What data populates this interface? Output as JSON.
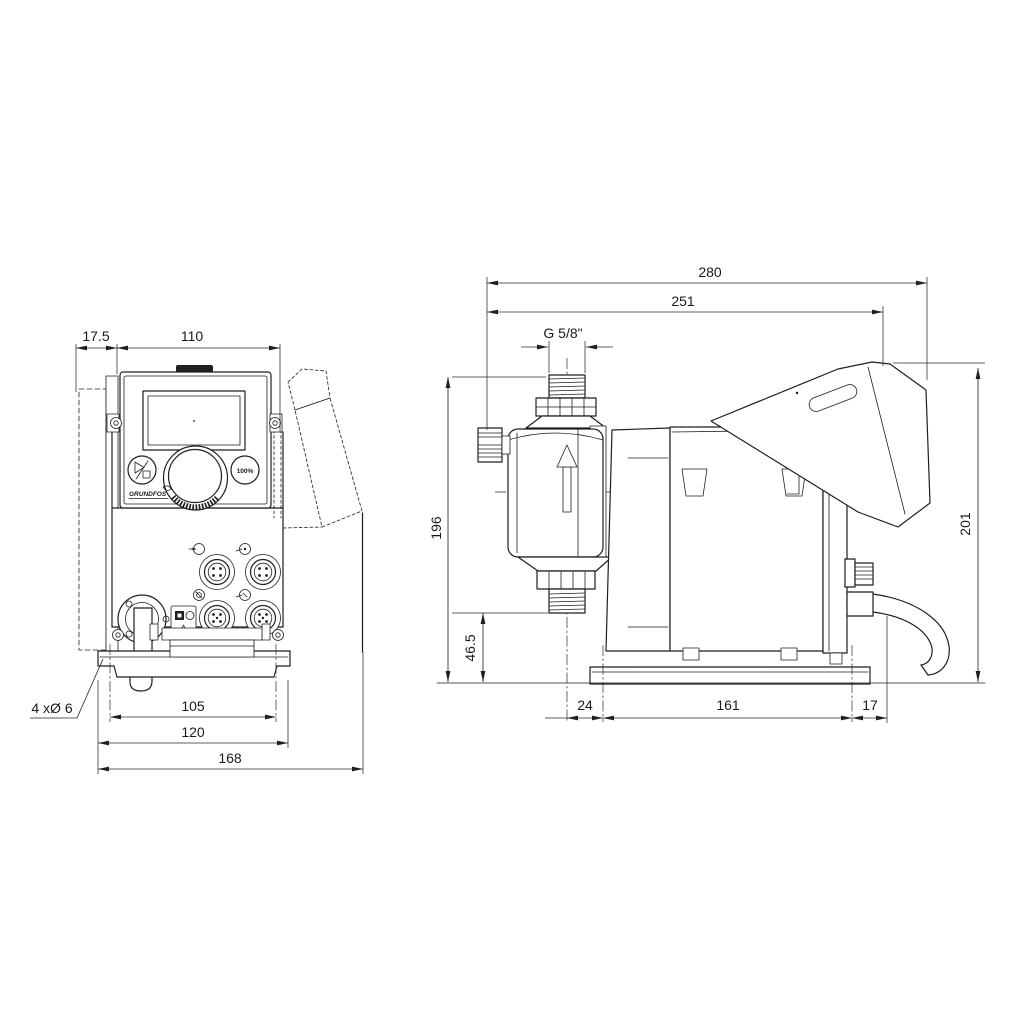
{
  "brand": "GRUNDFOS",
  "controls": {
    "max_capacity_label": "100%"
  },
  "front_view": {
    "dims": {
      "wall_plate_offset": "17.5",
      "control_panel_width": "110",
      "mounting_holes": "4 xØ 6",
      "hole_spacing": "105",
      "base_plate_width": "120",
      "overall_width": "168"
    }
  },
  "side_view": {
    "dims": {
      "overall_depth": "280",
      "depth_to_control_cube": "251",
      "connection_thread": "G 5/8\"",
      "inlet_connection_height": "196",
      "outlet_connection_height": "46.5",
      "overall_height": "201",
      "head_center_to_base": "24",
      "base_plate_depth": "161",
      "base_to_rear": "17"
    }
  }
}
